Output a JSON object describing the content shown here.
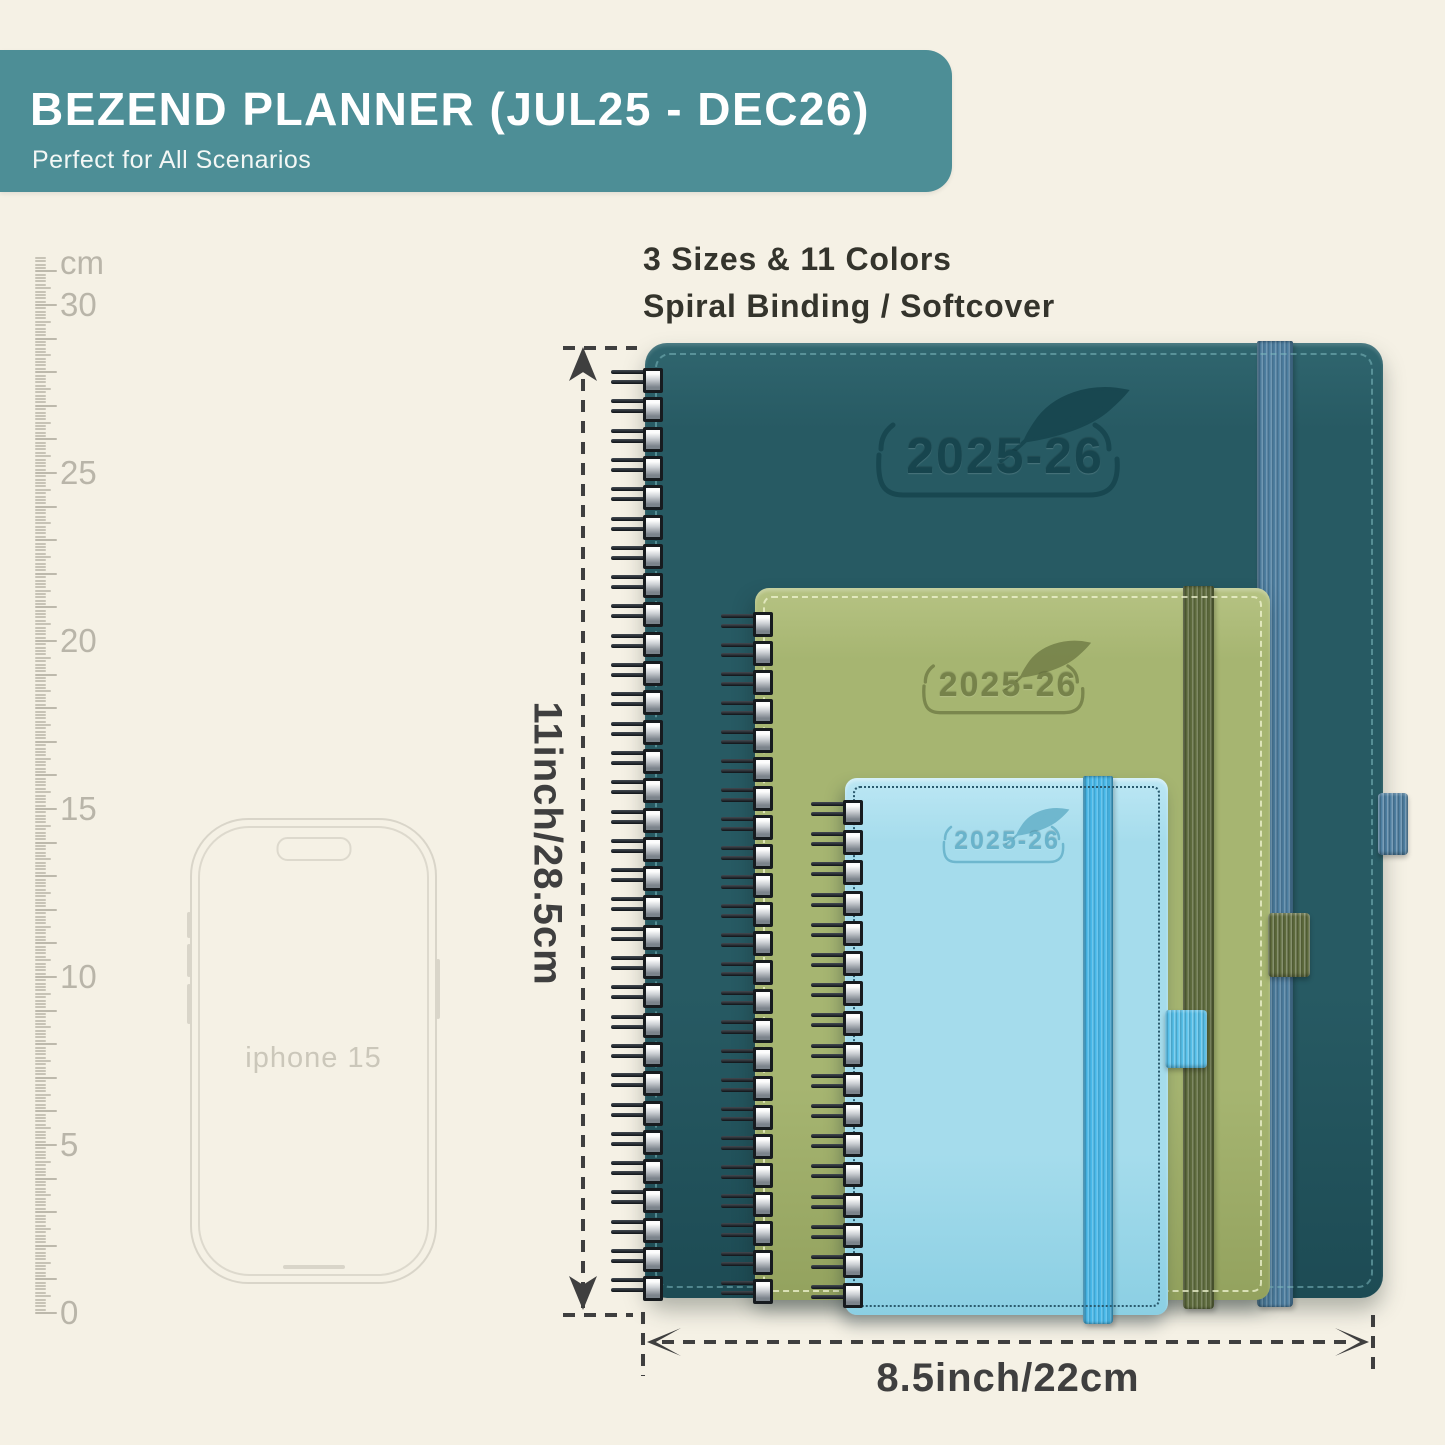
{
  "banner": {
    "title": "BEZEND PLANNER (JUL25 - DEC26)",
    "subtitle": "Perfect for All Scenarios"
  },
  "info": {
    "line1": "3 Sizes & 11 Colors",
    "line2": "Spiral Binding / Softcover"
  },
  "ruler": {
    "unit": "cm",
    "tick_labels": [
      "30",
      "25",
      "20",
      "15",
      "10",
      "5",
      "0"
    ]
  },
  "phone": {
    "label": "iphone 15"
  },
  "planners": {
    "large": {
      "year": "2025-26",
      "cover": "#275a63",
      "band": "#4d7ea0",
      "stitch": "rgba(125,185,190,0.55)",
      "emboss": "#17454e"
    },
    "medium": {
      "year": "2025-26",
      "cover": "#a6b571",
      "band": "#5e6b3d",
      "stitch": "rgba(240,244,210,0.75)",
      "emboss": "#76824a"
    },
    "small": {
      "year": "2025-26",
      "cover": "#a5dcec",
      "band": "#47b8e9",
      "stitch": "#2a5a6e",
      "emboss": "#69b3cb"
    }
  },
  "dimensions": {
    "height": "11inch/28.5cm",
    "width": "8.5inch/22cm"
  },
  "colors": {
    "background": "#f5f1e5",
    "banner": "#4d8e96",
    "annotation": "#3f3f3f"
  }
}
